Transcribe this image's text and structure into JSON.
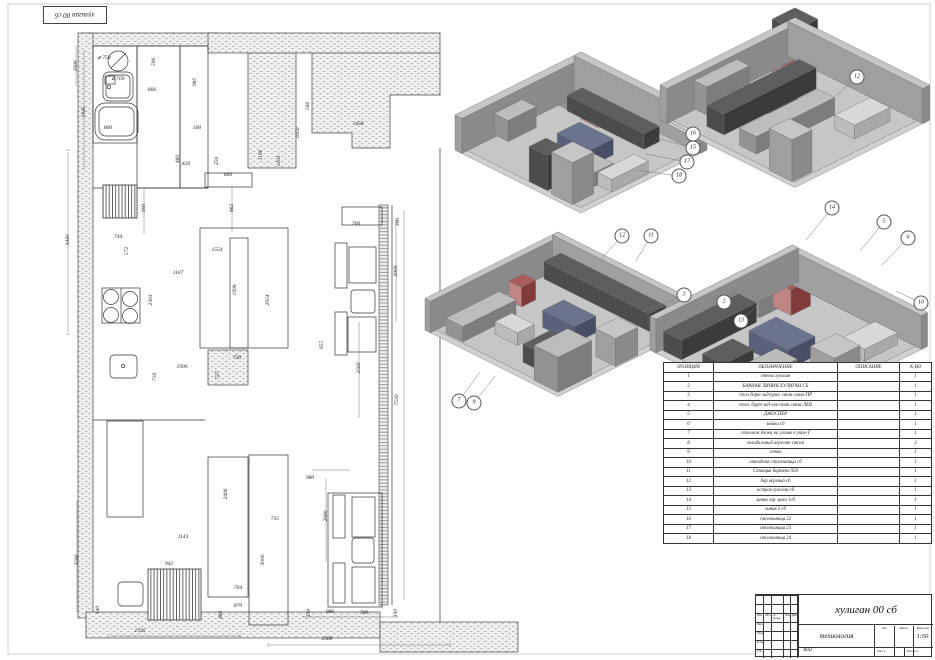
{
  "corner_stamp": "хулиган 00 сб",
  "colors": {
    "line": "#2b2b2b",
    "stipple": "#bdbdbd",
    "iso_red": "#a85c5c",
    "iso_blue": "#6a748c",
    "iso_gray": "#bdbdbd"
  },
  "plan": {
    "dimensions": [
      {
        "t": "3440",
        "x": 68,
        "y": 240,
        "r": 1
      },
      {
        "t": "1945",
        "x": 84,
        "y": 112,
        "r": 1
      },
      {
        "t": "1090",
        "x": 76,
        "y": 66,
        "r": 1
      },
      {
        "t": "⌀ 750",
        "x": 104,
        "y": 58,
        "r": 0
      },
      {
        "t": "⌀ 769",
        "x": 118,
        "y": 79,
        "r": 0
      },
      {
        "t": "596",
        "x": 154,
        "y": 62,
        "r": 1
      },
      {
        "t": "806",
        "x": 152,
        "y": 90,
        "r": 0
      },
      {
        "t": "985",
        "x": 195,
        "y": 82,
        "r": 1
      },
      {
        "t": "800",
        "x": 108,
        "y": 128,
        "r": 0
      },
      {
        "t": "500",
        "x": 197,
        "y": 128,
        "r": 0
      },
      {
        "t": "460",
        "x": 178,
        "y": 159,
        "r": 1
      },
      {
        "t": "420",
        "x": 186,
        "y": 164,
        "r": 0
      },
      {
        "t": "256",
        "x": 217,
        "y": 161,
        "r": 1
      },
      {
        "t": "800",
        "x": 228,
        "y": 175,
        "r": 0
      },
      {
        "t": "1190",
        "x": 261,
        "y": 155,
        "r": 1
      },
      {
        "t": "1203",
        "x": 279,
        "y": 161,
        "r": 1
      },
      {
        "t": "1050",
        "x": 298,
        "y": 133,
        "r": 1
      },
      {
        "t": "566",
        "x": 308,
        "y": 106,
        "r": 1
      },
      {
        "t": "1458",
        "x": 358,
        "y": 124,
        "r": 0
      },
      {
        "t": "900",
        "x": 144,
        "y": 208,
        "r": 1
      },
      {
        "t": "862",
        "x": 232,
        "y": 208,
        "r": 1
      },
      {
        "t": "744",
        "x": 118,
        "y": 237,
        "r": 0
      },
      {
        "t": "572",
        "x": 127,
        "y": 251,
        "r": 1
      },
      {
        "t": "1107",
        "x": 178,
        "y": 273,
        "r": 0
      },
      {
        "t": "2303",
        "x": 151,
        "y": 300,
        "r": 1
      },
      {
        "t": "1554",
        "x": 217,
        "y": 250,
        "r": 0
      },
      {
        "t": "1998",
        "x": 235,
        "y": 290,
        "r": 1
      },
      {
        "t": "2954",
        "x": 268,
        "y": 300,
        "r": 1
      },
      {
        "t": "700",
        "x": 356,
        "y": 224,
        "r": 0
      },
      {
        "t": "300",
        "x": 398,
        "y": 222,
        "r": 1
      },
      {
        "t": "955",
        "x": 322,
        "y": 345,
        "r": 1
      },
      {
        "t": "2000",
        "x": 396,
        "y": 271,
        "r": 1
      },
      {
        "t": "2560",
        "x": 359,
        "y": 368,
        "r": 1
      },
      {
        "t": "7530",
        "x": 397,
        "y": 400,
        "r": 1
      },
      {
        "t": "1990",
        "x": 182,
        "y": 367,
        "r": 0
      },
      {
        "t": "730",
        "x": 237,
        "y": 358,
        "r": 0
      },
      {
        "t": "716",
        "x": 155,
        "y": 377,
        "r": 1
      },
      {
        "t": "727",
        "x": 218,
        "y": 375,
        "r": 1
      },
      {
        "t": "3580",
        "x": 77,
        "y": 560,
        "r": 1
      },
      {
        "t": "140",
        "x": 98,
        "y": 610,
        "r": 1
      },
      {
        "t": "2496",
        "x": 226,
        "y": 494,
        "r": 1
      },
      {
        "t": "1143",
        "x": 183,
        "y": 537,
        "r": 0
      },
      {
        "t": "942",
        "x": 169,
        "y": 564,
        "r": 0
      },
      {
        "t": "735",
        "x": 275,
        "y": 519,
        "r": 0
      },
      {
        "t": "3000",
        "x": 263,
        "y": 560,
        "r": 1
      },
      {
        "t": "980",
        "x": 310,
        "y": 478,
        "r": 0
      },
      {
        "t": "2080",
        "x": 326,
        "y": 516,
        "r": 1
      },
      {
        "t": "704",
        "x": 238,
        "y": 588,
        "r": 0
      },
      {
        "t": "870",
        "x": 238,
        "y": 606,
        "r": 0
      },
      {
        "t": "480",
        "x": 221,
        "y": 615,
        "r": 1
      },
      {
        "t": "330",
        "x": 309,
        "y": 613,
        "r": 1
      },
      {
        "t": "980",
        "x": 330,
        "y": 612,
        "r": 0
      },
      {
        "t": "700",
        "x": 364,
        "y": 613,
        "r": 0
      },
      {
        "t": "330",
        "x": 396,
        "y": 613,
        "r": 1
      },
      {
        "t": "2380",
        "x": 327,
        "y": 639,
        "r": 0
      },
      {
        "t": "1595",
        "x": 140,
        "y": 631,
        "r": 0
      }
    ]
  },
  "views": {
    "balloons": [
      {
        "n": "16",
        "x": 693,
        "y": 134,
        "tx": 662,
        "ty": 118
      },
      {
        "n": "15",
        "x": 693,
        "y": 148,
        "tx": 656,
        "ty": 138
      },
      {
        "n": "17",
        "x": 687,
        "y": 162,
        "tx": 646,
        "ty": 154
      },
      {
        "n": "18",
        "x": 679,
        "y": 176,
        "tx": 636,
        "ty": 170
      },
      {
        "n": "12",
        "x": 857,
        "y": 77,
        "tx": 836,
        "ty": 96
      },
      {
        "n": "12",
        "x": 622,
        "y": 236,
        "tx": 601,
        "ty": 259
      },
      {
        "n": "11",
        "x": 651,
        "y": 236,
        "tx": 636,
        "ty": 261
      },
      {
        "n": "7",
        "x": 459,
        "y": 401,
        "tx": 480,
        "ty": 372
      },
      {
        "n": "9",
        "x": 474,
        "y": 403,
        "tx": 495,
        "ty": 376
      },
      {
        "n": "3",
        "x": 684,
        "y": 295,
        "tx": 642,
        "ty": 312
      },
      {
        "n": "2",
        "x": 724,
        "y": 302,
        "tx": 746,
        "ty": 281
      },
      {
        "n": "13",
        "x": 741,
        "y": 321,
        "tx": 762,
        "ty": 301
      },
      {
        "n": "14",
        "x": 832,
        "y": 208,
        "tx": 806,
        "ty": 240
      },
      {
        "n": "5",
        "x": 884,
        "y": 222,
        "tx": 860,
        "ty": 251
      },
      {
        "n": "6",
        "x": 908,
        "y": 238,
        "tx": 881,
        "ty": 266
      },
      {
        "n": "10",
        "x": 921,
        "y": 303,
        "tx": 896,
        "ty": 291
      }
    ]
  },
  "spec_table": {
    "headers": [
      "ПОЗИЦИЯ",
      "ОБОЗНАЧЕНИЕ",
      "ОПИСАНИЕ",
      "К-ВО"
    ],
    "rows": [
      [
        "1",
        "стены хулиган",
        "",
        "1"
      ],
      [
        "2",
        "БАРНАЯ ЛИНИЯ ХУЛИГАН СБ",
        "",
        "1"
      ],
      [
        "3",
        "стол борт зад-прав. стан связи-ПР",
        "",
        "1"
      ],
      [
        "4",
        "стол. борт зад-лев стан.связи-ЛЕВ",
        "",
        "1"
      ],
      [
        "5",
        "ДЖОСПЕР",
        "",
        "1"
      ],
      [
        "6",
        "мойка сб",
        "",
        "1"
      ],
      [
        "7",
        "стеллаж блоки на уголке в упак-Т",
        "",
        "1"
      ],
      [
        "8",
        "холодильный агрегат стола",
        "",
        "2"
      ],
      [
        "9",
        "сетка",
        "",
        "1"
      ],
      [
        "10",
        "откидная столешница сб",
        "",
        "1"
      ],
      [
        "11",
        "Станция бармена 950",
        "",
        "1"
      ],
      [
        "12",
        "бар верхний сб",
        "",
        "1"
      ],
      [
        "13",
        "остров хулиган сб",
        "",
        "1"
      ],
      [
        "14",
        "линия гор. цеха 1сб",
        "",
        "1"
      ],
      [
        "15",
        "линия 2 сб",
        "",
        "1"
      ],
      [
        "16",
        "столешница 22",
        "",
        "1"
      ],
      [
        "17",
        "столешница 23",
        "",
        "1"
      ],
      [
        "18",
        "столешница 24",
        "",
        "1"
      ]
    ]
  },
  "title_block": {
    "doc_title": "хулиган 00 сб",
    "tech": "технология",
    "material": "AISI",
    "lit_label": "Лит.",
    "mass_label": "Масса",
    "scale_label": "Масштаб",
    "scale": "1:50",
    "sheet": "Лист 1",
    "sheets": "Листов 1",
    "sig_headers": [
      "Изм.",
      "Лист",
      "№ докум.",
      "Подп.",
      "Дата"
    ],
    "sig_rows": [
      "Разраб.",
      "Пров.",
      "Н.контр.",
      "Утв."
    ]
  }
}
